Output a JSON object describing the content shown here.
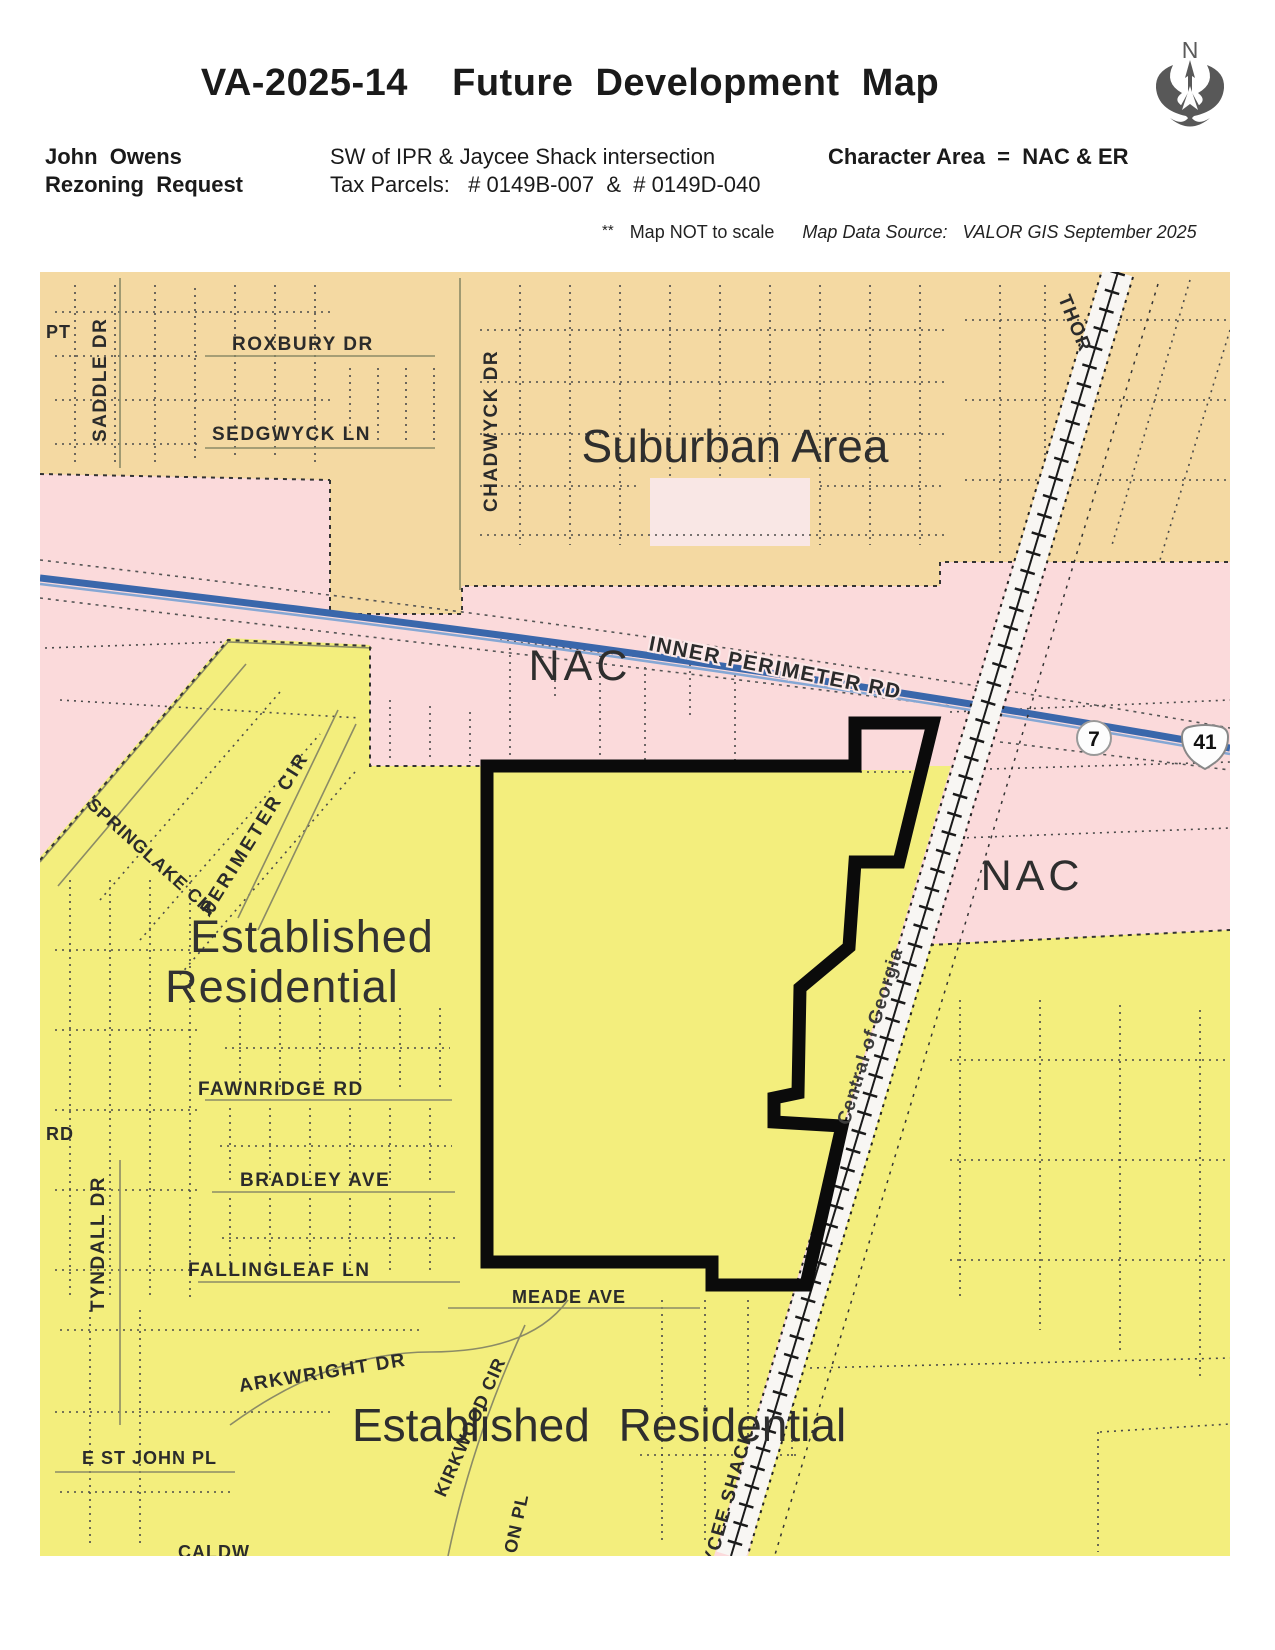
{
  "header": {
    "title": "VA-2025-14    Future  Development  Map",
    "applicant_name": "John  Owens",
    "applicant_type": "Rezoning  Request",
    "location": "SW of IPR & Jaycee Shack intersection",
    "tax_parcels": "Tax Parcels:   # 0149B-007  &  # 0149D-040",
    "character_area": "Character Area  =  NAC & ER",
    "note_marker": "**",
    "note_scale": "Map NOT to scale",
    "note_source": "Map Data Source:   VALOR GIS September 2025",
    "north_label": "N"
  },
  "map": {
    "areas": {
      "suburban": "Suburban Area",
      "nac_west": "NAC",
      "nac_east": "NAC",
      "er_left_line1": "Established",
      "er_left_line2": "Residential",
      "er_bottom": "Established Residential"
    },
    "streets": {
      "pt": "PT",
      "saddle": "SADDLE DR",
      "roxbury": "ROXBURY DR",
      "sedgwyck": "SEDGWYCK LN",
      "chadwyck": "CHADWYCK DR",
      "thor": "THOR",
      "inner_perimeter": "INNER PERIMETER RD",
      "springlake": "SPRINGLAKE CIR",
      "perimeter_cir": "PERIMETER CIR",
      "rd_partial": "RD",
      "tyndall": "TYNDALL DR",
      "fawnridge": "FAWNRIDGE RD",
      "bradley": "BRADLEY AVE",
      "fallingleaf": "FALLINGLEAF LN",
      "meade": "MEADE AVE",
      "arkwright": "ARKWRIGHT DR",
      "kirkwood": "KIRKWOOD CIR",
      "e_st_john": "E ST JOHN PL",
      "caldwell_partial": "CALDW",
      "on_pl_partial": "ON PL",
      "jaycee": "JAYCEE SHACK"
    },
    "railroad_label": "Central of Georgia",
    "routes": {
      "state_route": "7",
      "us_route": "41"
    },
    "colors": {
      "suburban_area": "#f4d9a2",
      "nac": "#fbdadb",
      "established_residential": "#f3ee7d",
      "highway_blue": "#3a67ab",
      "parcel_outline": "#0b0b0b",
      "railroad_band": "#f8f6f3"
    }
  }
}
